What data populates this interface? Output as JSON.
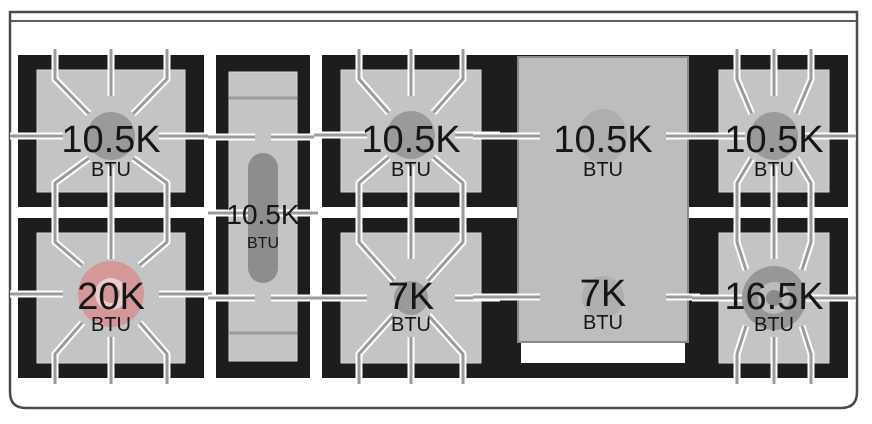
{
  "diagram": {
    "title": "range-cooktop-burner-btu-diagram",
    "burners": [
      {
        "id": "top-left",
        "label": "10.5K",
        "unit": "BTU",
        "highlighted": false
      },
      {
        "id": "bottom-left",
        "label": "20K",
        "unit": "BTU",
        "highlighted": true
      },
      {
        "id": "center-left-oval",
        "label": "10.5K",
        "unit": "BTU",
        "highlighted": false
      },
      {
        "id": "top-middle",
        "label": "10.5K",
        "unit": "BTU",
        "highlighted": false
      },
      {
        "id": "bottom-middle",
        "label": "7K",
        "unit": "BTU",
        "highlighted": false
      },
      {
        "id": "griddle-top",
        "label": "10.5K",
        "unit": "BTU",
        "highlighted": false
      },
      {
        "id": "griddle-bottom",
        "label": "7K",
        "unit": "BTU",
        "highlighted": false
      },
      {
        "id": "top-right",
        "label": "10.5K",
        "unit": "BTU",
        "highlighted": false
      },
      {
        "id": "bottom-right",
        "label": "16.5K",
        "unit": "BTU",
        "highlighted": false
      }
    ],
    "colors": {
      "highlight": "#d59899",
      "highlight_ring": "#e9cdcd",
      "grate_black": "#1d1d1d",
      "surface_gray": "#c4c4c4",
      "burner_gray": "#9a9a9a",
      "dual_ring_gray": "#bcbcbc",
      "griddle_gray": "#bdbdbd",
      "oval_gray": "#8d8d8d",
      "line_gray": "#9b9b9b",
      "frame_gray": "#4a4a4a"
    }
  }
}
